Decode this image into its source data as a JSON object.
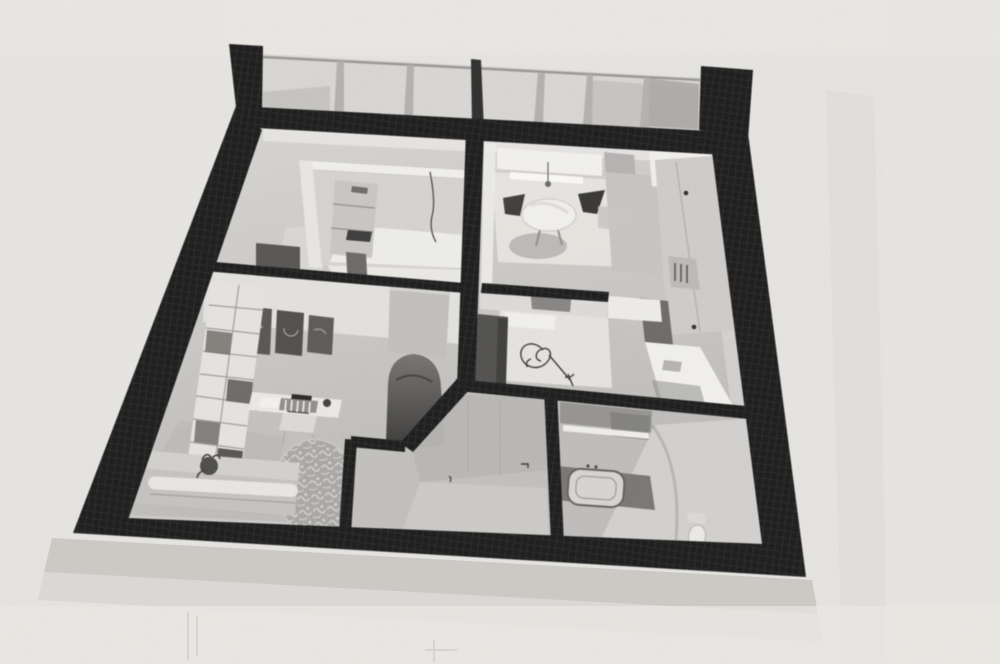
{
  "image": {
    "kind": "black-and-white photograph of a printed 3D floor-plan rendering",
    "view": "axonometric top-down, slightly tilted perspective",
    "paper": "plain light paper, soft shadow band under the plan, no visible text"
  },
  "colors": {
    "paper": "#e7e5e1",
    "paper_light": "#edebe7",
    "plan_shadow": "#c9c6c2",
    "band_shadow": "#d8d5d1",
    "wall": "#171717",
    "wall_weave": "#3d3d3d",
    "glass": "#d9d7d4",
    "mullion": "#b3b1ae",
    "floor_light": "#dbd9d6",
    "floor_mid": "#c9c7c4",
    "floor_dark": "#adabaa",
    "white_surface": "#f2f1ee",
    "furniture_light": "#e6e4e1",
    "furniture_mid": "#bab8b5",
    "furniture_dark": "#4c4b49",
    "sofa": "#c5c3c0",
    "rug": "#a9a7a4",
    "ink": "#3a3938"
  },
  "structure": {
    "outer_walls": "thick black poche walls forming a trapezoid in perspective",
    "window_band": "glazed wall with vertical mullions along the whole top edge"
  },
  "rooms": [
    {
      "name": "bedroom-office",
      "items": [
        "window alcove with white frame",
        "small shelf unit",
        "thin lamp cable",
        "dark wardrobe corner",
        "sunlit floor patch"
      ]
    },
    {
      "name": "kitchen-dining",
      "items": [
        "round white table",
        "two dark shell chairs",
        "floor shadow",
        "balcony door frame",
        "tall kitchen cabinets with round handles",
        "bottle shelf",
        "bright white counter"
      ]
    },
    {
      "name": "living-room",
      "items": [
        "white cube bookshelf",
        "three dark floral framed pictures",
        "white desk",
        "laptop",
        "open book",
        "slat-back chair",
        "ornate round rug",
        "long sofa with bright bolster cushion",
        "dark potted plant",
        "grey wardrobe block",
        "dark round-back armchair"
      ]
    },
    {
      "name": "small-bedroom",
      "items": [
        "bed with rose sketch on bedspread",
        "dark side cabinet",
        "grey headboard"
      ]
    },
    {
      "name": "hallway",
      "items": [
        "angled partition wall",
        "door seams",
        "small door handle mark"
      ]
    },
    {
      "name": "bathroom",
      "items": [
        "mirror strip",
        "dark vanity counter",
        "light basin",
        "toilet",
        "sunlit right wall"
      ]
    }
  ]
}
